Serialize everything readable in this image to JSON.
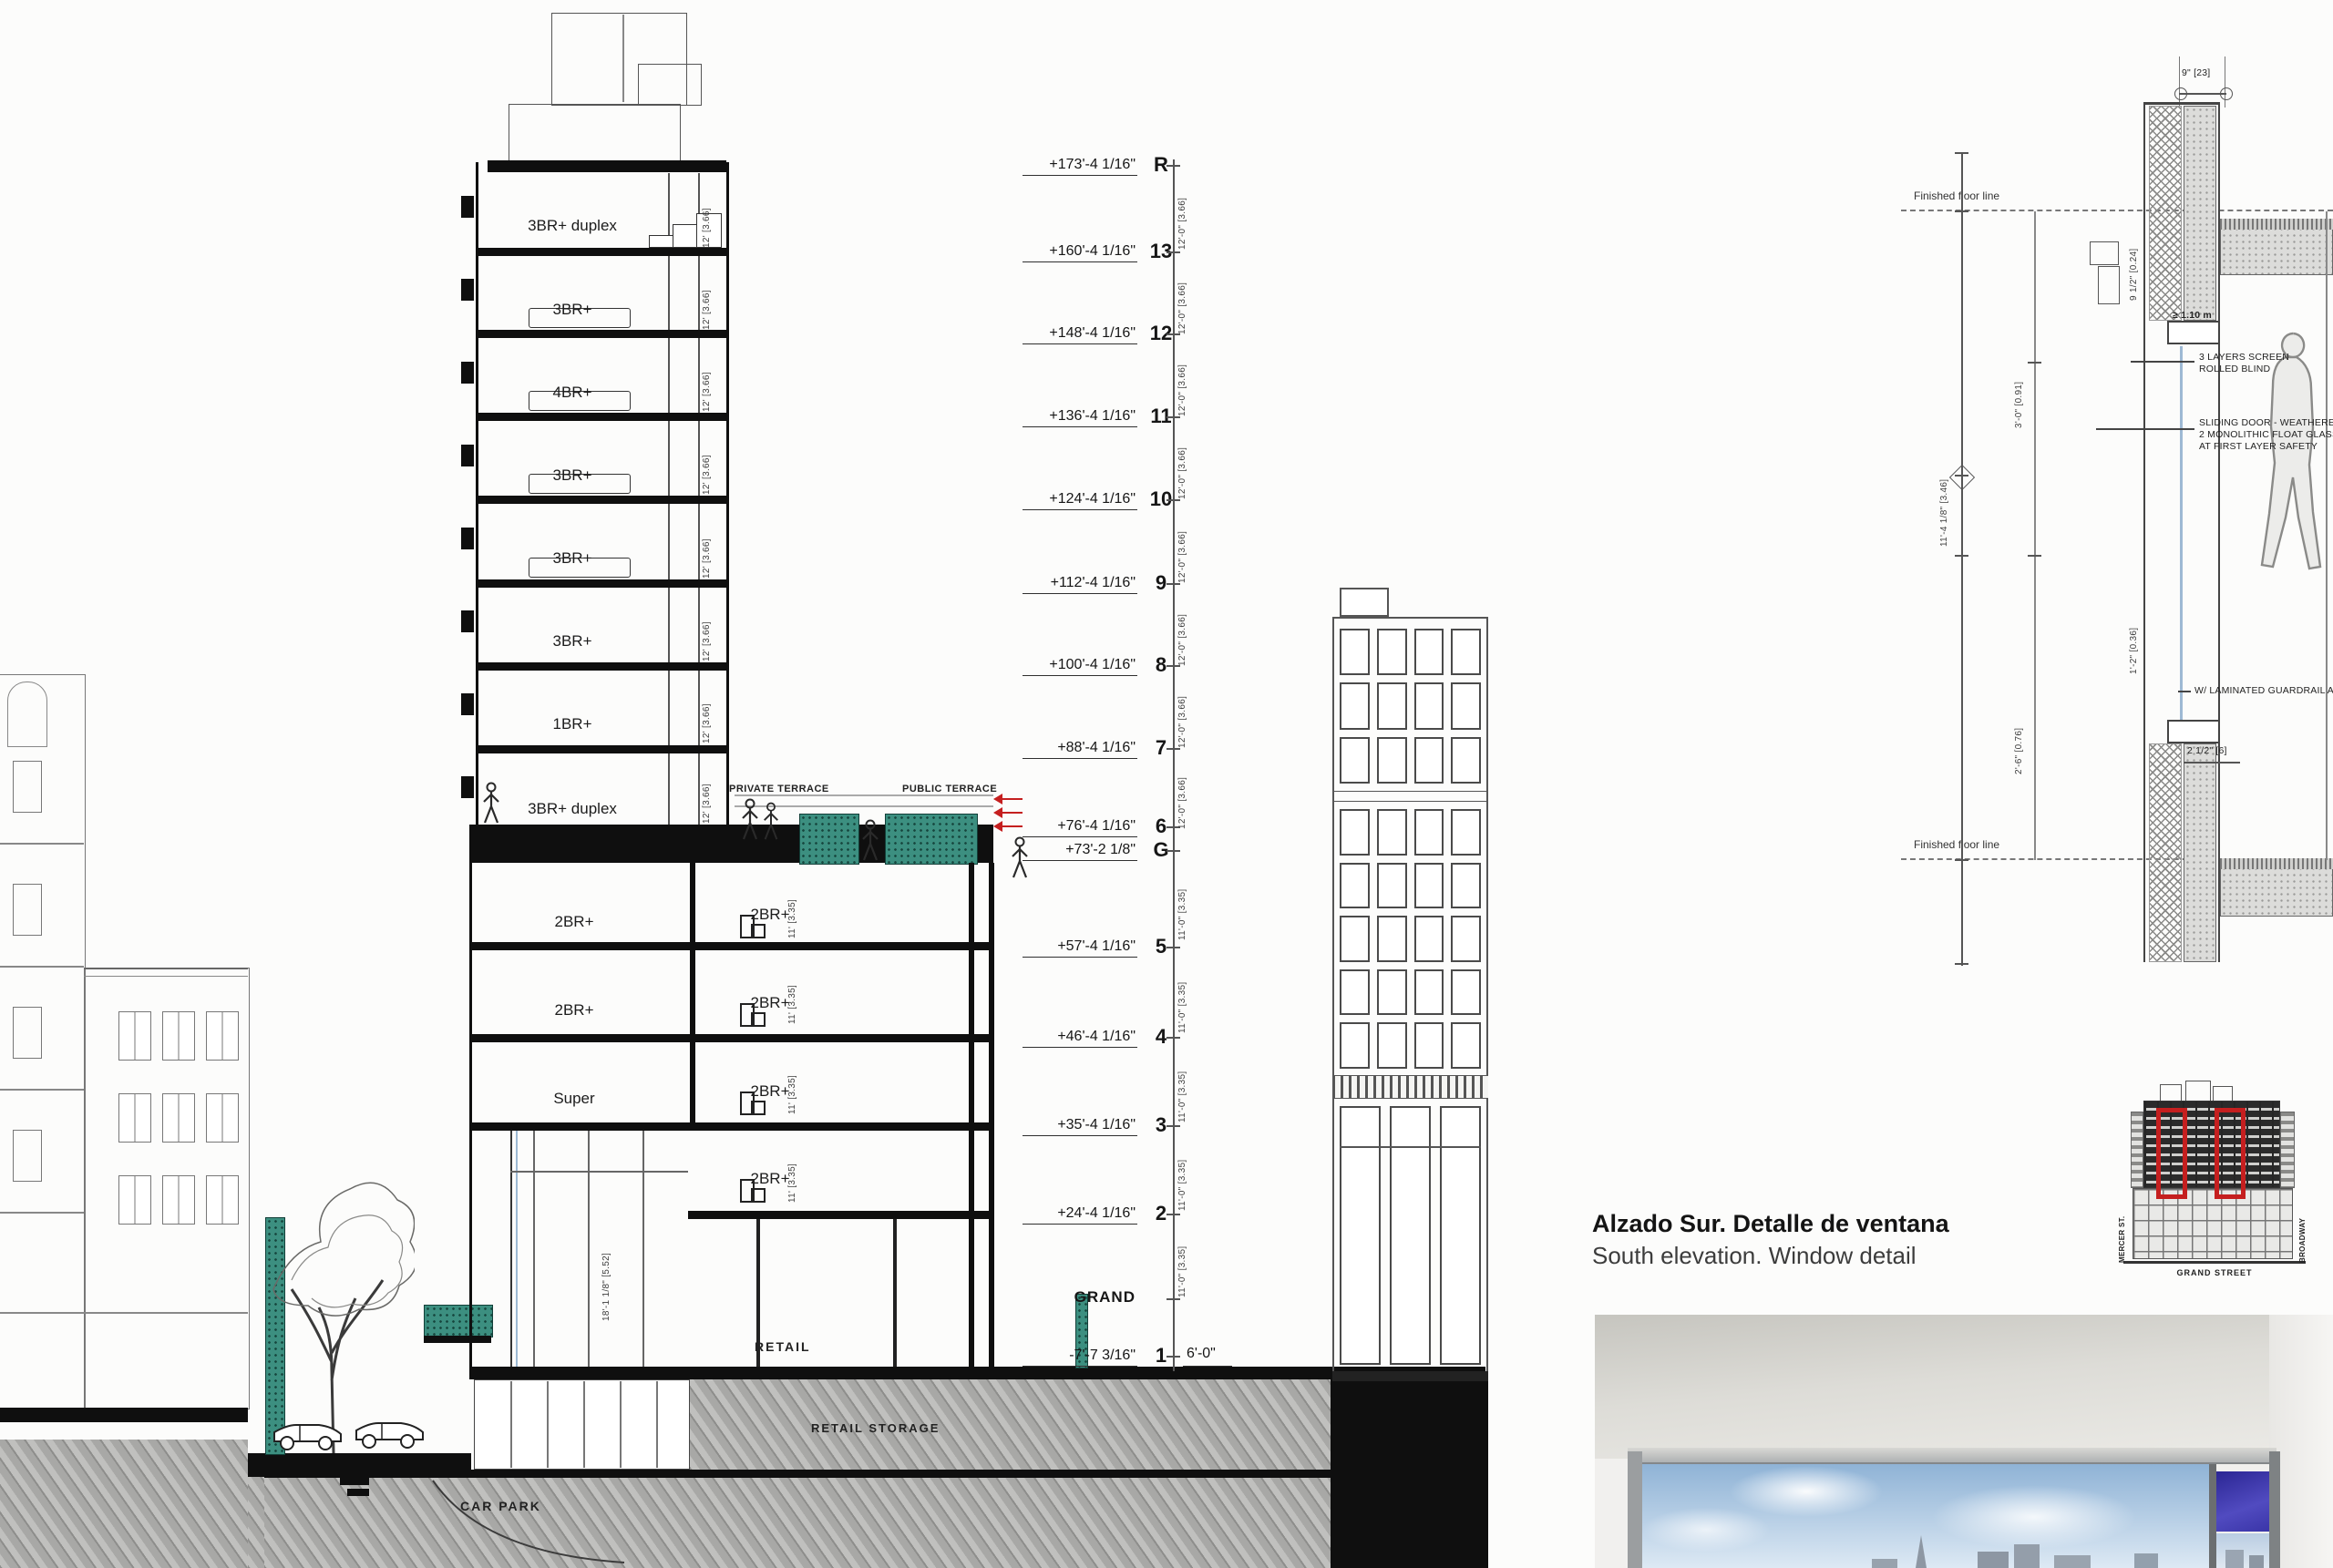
{
  "caption": {
    "title": "Alzado Sur. Detalle de ventana",
    "subtitle": "South elevation. Window detail"
  },
  "section": {
    "levels": [
      {
        "elev": "+173'-4 1/16\"",
        "floor": "R"
      },
      {
        "elev": "+160'-4 1/16\"",
        "floor": "13"
      },
      {
        "elev": "+148'-4 1/16\"",
        "floor": "12"
      },
      {
        "elev": "+136'-4 1/16\"",
        "floor": "11"
      },
      {
        "elev": "+124'-4 1/16\"",
        "floor": "10"
      },
      {
        "elev": "+112'-4 1/16\"",
        "floor": "9"
      },
      {
        "elev": "+100'-4 1/16\"",
        "floor": "8"
      },
      {
        "elev": "+88'-4 1/16\"",
        "floor": "7"
      },
      {
        "elev": "+76'-4 1/16\"",
        "floor": "6"
      },
      {
        "elev": "+73'-2 1/8\"",
        "floor": "G"
      },
      {
        "elev": "+57'-4 1/16\"",
        "floor": "5"
      },
      {
        "elev": "+46'-4 1/16\"",
        "floor": "4"
      },
      {
        "elev": "+35'-4 1/16\"",
        "floor": "3"
      },
      {
        "elev": "+24'-4 1/16\"",
        "floor": "2"
      },
      {
        "elev": "GRAND",
        "floor": ""
      },
      {
        "elev": "-7'-7 3/16\"",
        "floor": "1"
      }
    ],
    "grade_dim": "6'-0\"",
    "tower_units": [
      "3BR+ duplex",
      "3BR+",
      "4BR+",
      "3BR+",
      "3BR+",
      "3BR+",
      "1BR+",
      "3BR+ duplex"
    ],
    "lower_left_units": [
      "2BR+",
      "2BR+",
      "Super"
    ],
    "lower_right_units": [
      "2BR+",
      "2BR+",
      "2BR+",
      "2BR+"
    ],
    "terraces": {
      "private": "PRIVATE TERRACE",
      "public": "PUBLIC TERRACE"
    },
    "spaces": {
      "retail": "RETAIL",
      "retail_storage": "RETAIL STORAGE",
      "car_park": "CAR PARK"
    },
    "dims": {
      "tower_floor": "12'-0\" [3.66]",
      "lower_floor": "11'-0\" [3.35]",
      "interior_tower": "12' [3.66]",
      "interior_lower": "11' [3.35]",
      "atrium": "18'-1 1/8\" [5.52]"
    }
  },
  "detail": {
    "floor_line": "Finished floor line",
    "notes": {
      "blind1": "3 LAYERS SCREEN",
      "blind2": "ROLLED BLIND",
      "door1": "SLIDING DOOR - WEATHERED",
      "door2": "2 MONOLITHIC FLOAT GLASS",
      "door3": "AT FIRST LAYER SAFETY",
      "guard": "W/ LAMINATED GUARDRAIL AT 42IN",
      "guard_min": "≥ 1.10 m"
    },
    "dims": {
      "head": "9\" [23]",
      "height": "11'-4 1/8\" [3.46]",
      "d1": "3'-0\" [0.91]",
      "d2": "2'-6\" [0.76]",
      "d3": "9 1/2\" [0.24]",
      "d4": "1'-2\" [0.36]",
      "d5": "2 1/2\" [6]"
    }
  },
  "thumbnail": {
    "street_bottom": "GRAND STREET",
    "street_left": "MERCER ST.",
    "street_right": "BROADWAY"
  },
  "colors": {
    "highlight_red": "#c51f1f",
    "hedge_teal": "#3c8f80",
    "glass_blue": "#9db9d4",
    "pane_blue": "#322da0"
  }
}
